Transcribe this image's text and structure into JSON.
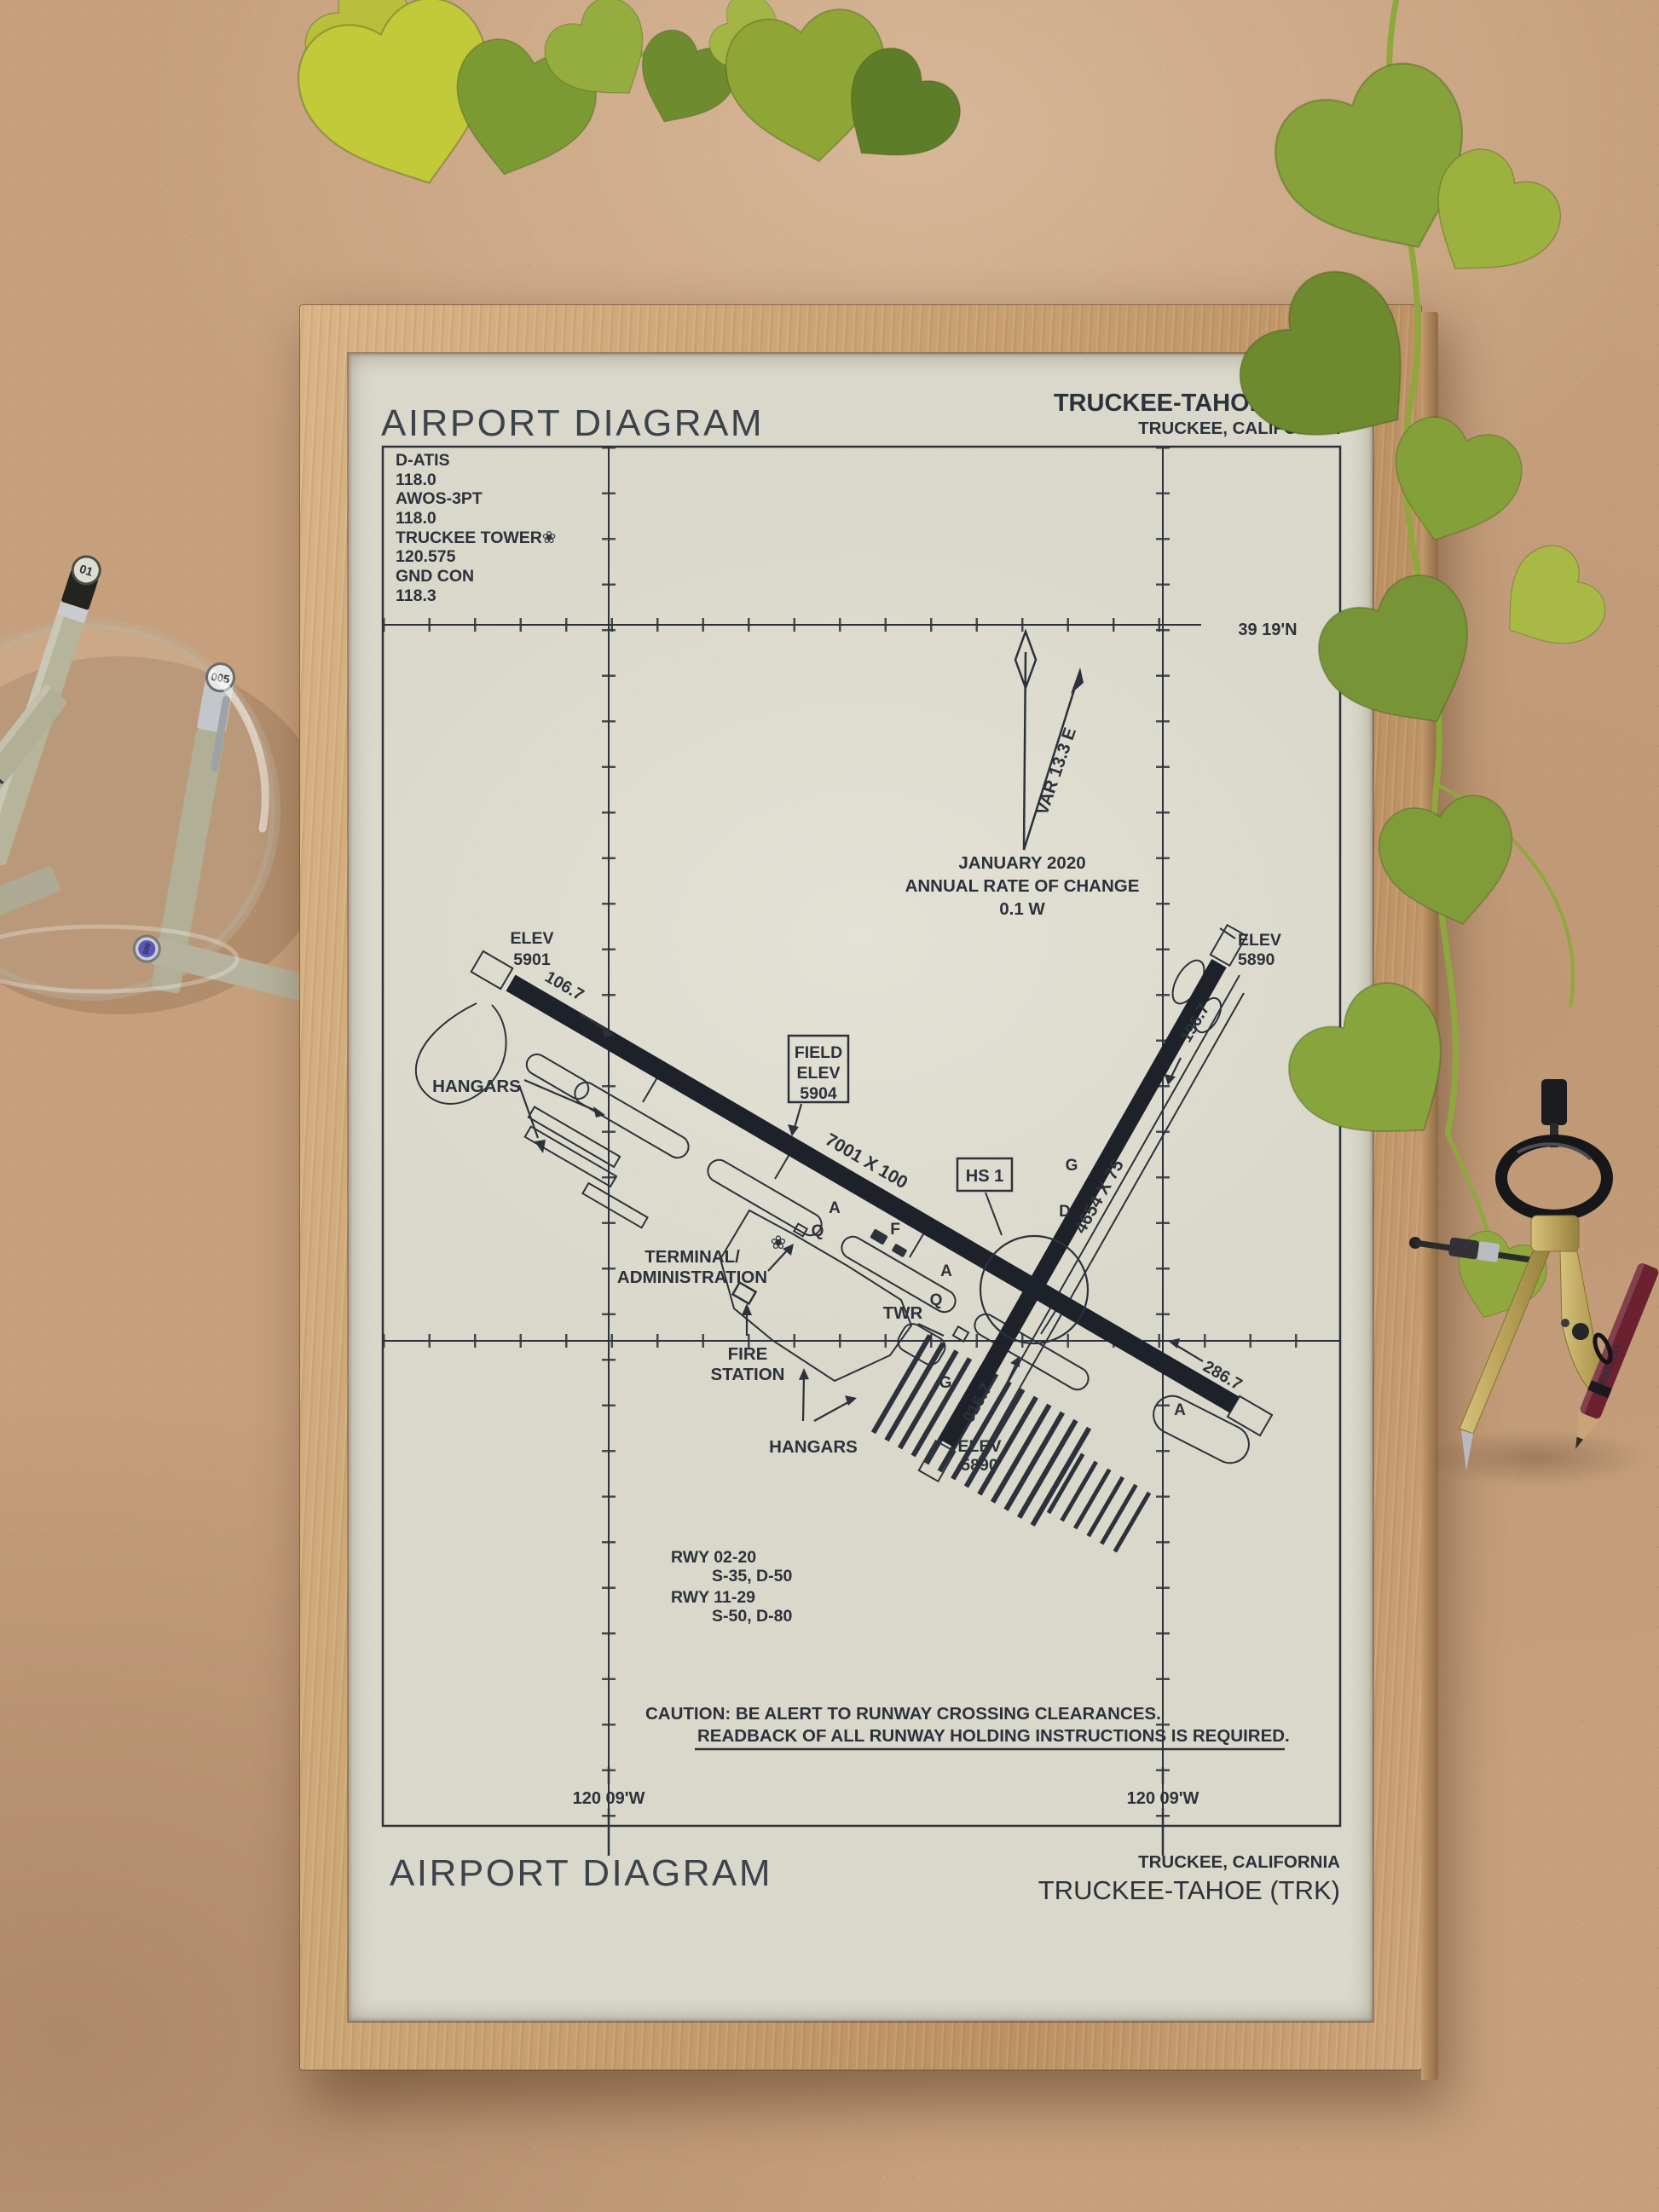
{
  "scene": {
    "pens": {
      "cap1": "01",
      "cap2": "005",
      "cap3": "005",
      "barrel": "MICRON",
      "pencil_brand": "GENERAL"
    },
    "colors": {
      "board": "#c6a07c",
      "frame_wood": "#c9a273",
      "paper": "#dad8ca",
      "ink": "#2c313b",
      "leaf_green": "#82a03a"
    }
  },
  "diagram": {
    "header": {
      "title": "AIRPORT DIAGRAM",
      "airport": "TRUCKEE-TAHOE (TRK)",
      "city": "TRUCKEE, CALIFORNIA"
    },
    "footer": {
      "title": "AIRPORT DIAGRAM",
      "city": "TRUCKEE, CALIFORNIA",
      "airport": "TRUCKEE-TAHOE (TRK)"
    },
    "frequencies": [
      {
        "label": "D-ATIS",
        "value": "118.0"
      },
      {
        "label": "AWOS-3PT",
        "value": "118.0"
      },
      {
        "label": "TRUCKEE TOWER❀",
        "value": "120.575"
      },
      {
        "label": "GND CON",
        "value": "118.3"
      }
    ],
    "graticule": {
      "lat": "39 19'N",
      "lon_left": "120 09'W",
      "lon_right": "120 09'W"
    },
    "variation": {
      "var": "VAR 13.3 E",
      "date": "JANUARY 2020",
      "note": "ANNUAL RATE OF CHANGE",
      "rate": "0.1  W"
    },
    "field_elev": [
      "FIELD",
      "ELEV",
      "5904"
    ],
    "hot_spot": "HS 1",
    "beacon_glyph": "❀",
    "runway_11_29": {
      "dim": "7001 X 100",
      "hdg11": "106.7",
      "hdg29": "286.7",
      "elev11": [
        "ELEV",
        "5901"
      ]
    },
    "runway_02_20": {
      "dim": "4654 X 75",
      "hdg02": "016.7",
      "hdg20": "196.7",
      "elev02": [
        "ELEV",
        "5890"
      ],
      "elev20": [
        "ELEV",
        "5890"
      ]
    },
    "labels": {
      "hangars_nw": "HANGARS",
      "hangars_s": "HANGARS",
      "terminal": [
        "TERMINAL/",
        "ADMINISTRATION"
      ],
      "fire": [
        "FIRE",
        "STATION"
      ],
      "twr": "TWR"
    },
    "taxiways": [
      "A",
      "Q",
      "F",
      "A",
      "G",
      "D",
      "G",
      "Q",
      "A"
    ],
    "runway_data": [
      "RWY 02-20",
      "S-35, D-50",
      "RWY 11-29",
      "S-50, D-80"
    ],
    "caution": [
      "CAUTION: BE ALERT TO RUNWAY CROSSING CLEARANCES.",
      "READBACK OF ALL RUNWAY HOLDING INSTRUCTIONS IS REQUIRED."
    ]
  }
}
